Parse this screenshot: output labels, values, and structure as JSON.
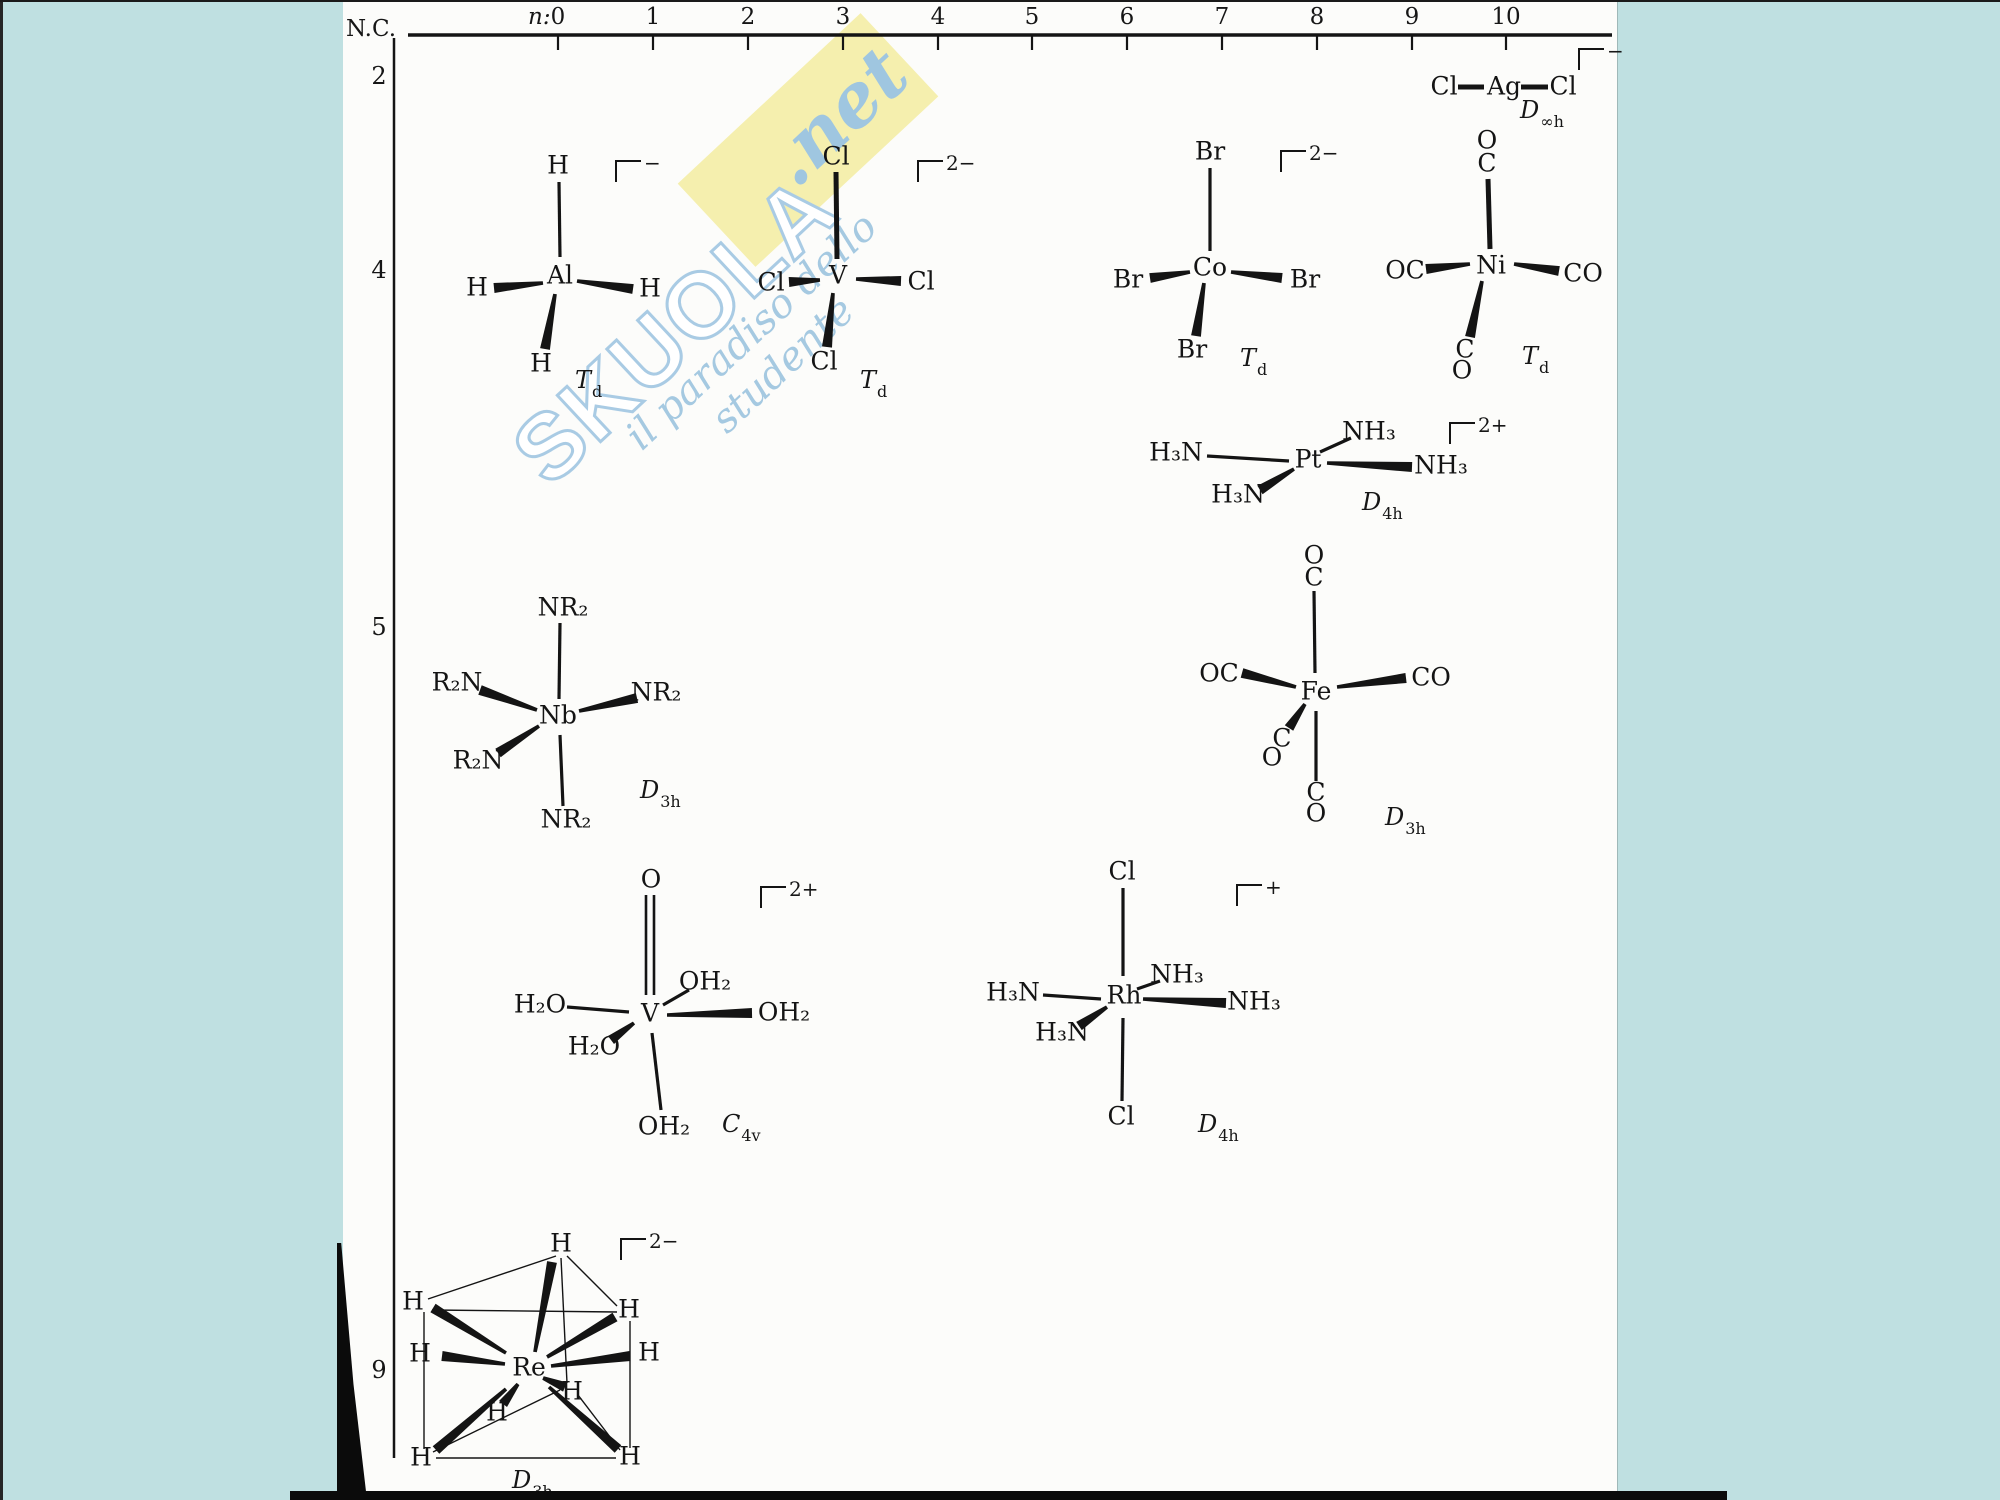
{
  "meta": {
    "description": "Scanned textbook figure: transition-metal complex geometries arranged by coordination number (N.C.) versus d-electron count (n)"
  },
  "watermark": {
    "brand": "SKUOLA",
    "domain": ".net",
    "tagline": "il paradiso dello studente",
    "band_color": "#f5efae",
    "text_color": "#a5c9e1"
  },
  "axis": {
    "nc_label": "N.C.",
    "n_label": "n:",
    "n_ticks": [
      {
        "label": "0",
        "x": 558
      },
      {
        "label": "1",
        "x": 653
      },
      {
        "label": "2",
        "x": 748
      },
      {
        "label": "3",
        "x": 843
      },
      {
        "label": "4",
        "x": 938
      },
      {
        "label": "5",
        "x": 1032
      },
      {
        "label": "6",
        "x": 1127
      },
      {
        "label": "7",
        "x": 1222
      },
      {
        "label": "8",
        "x": 1317
      },
      {
        "label": "9",
        "x": 1412
      },
      {
        "label": "10",
        "x": 1506
      }
    ],
    "nc_rows": [
      {
        "label": "2",
        "y": 76
      },
      {
        "label": "4",
        "y": 270
      },
      {
        "label": "5",
        "y": 627
      },
      {
        "label": "9",
        "y": 1370
      }
    ],
    "h_line": {
      "x1": 408,
      "y1": 35,
      "x2": 1612,
      "y2": 35
    },
    "v_line": {
      "x1": 394,
      "y1": 38,
      "x2": 394,
      "y2": 1458
    },
    "tick_len": 15
  },
  "molecules": [
    {
      "name": "dichloroargentate",
      "formula": "[AgCl2]-",
      "symmetry": {
        "main": "D",
        "sub": "∞h"
      },
      "sym_pos": [
        1520,
        98
      ],
      "charge": "−",
      "charge_pos": [
        1578,
        48
      ],
      "atoms": [
        [
          "Cl",
          1444,
          88
        ],
        [
          "Ag",
          1504,
          88
        ],
        [
          "Cl",
          1563,
          88
        ]
      ],
      "bonds": [
        [
          "thick",
          1458,
          87,
          1484,
          87
        ],
        [
          "thick",
          1521,
          87,
          1548,
          87
        ]
      ]
    },
    {
      "name": "tetrahydridoaluminate",
      "formula": "[AlH4]-",
      "symmetry": {
        "main": "T",
        "sub": "d"
      },
      "sym_pos": [
        575,
        368
      ],
      "charge": "−",
      "charge_pos": [
        615,
        160
      ],
      "atoms": [
        [
          "Al",
          560,
          277
        ],
        [
          "H",
          558,
          167
        ],
        [
          "H",
          477,
          289
        ],
        [
          "H",
          650,
          290
        ],
        [
          "H",
          541,
          365
        ]
      ],
      "bonds": [
        [
          "line",
          559,
          182,
          560,
          257
        ],
        [
          "wedge",
          543,
          283,
          494,
          288
        ],
        [
          "wedge",
          577,
          281,
          633,
          289
        ],
        [
          "wedge",
          555,
          294,
          545,
          349
        ]
      ]
    },
    {
      "name": "tetrachlorovanadate",
      "formula": "[VCl4]2-",
      "symmetry": {
        "main": "T",
        "sub": "d"
      },
      "sym_pos": [
        860,
        368
      ],
      "charge": "2−",
      "charge_pos": [
        917,
        160
      ],
      "atoms": [
        [
          "V",
          838,
          277
        ],
        [
          "Cl",
          836,
          158
        ],
        [
          "Cl",
          771,
          284
        ],
        [
          "Cl",
          921,
          283
        ],
        [
          "Cl",
          824,
          363
        ]
      ],
      "bonds": [
        [
          "thick",
          836,
          172,
          837,
          259
        ],
        [
          "wedge",
          820,
          280,
          789,
          282
        ],
        [
          "wedge",
          856,
          279,
          901,
          281
        ],
        [
          "wedge",
          833,
          293,
          827,
          347
        ]
      ]
    },
    {
      "name": "tetrabromocobaltate",
      "formula": "[CoBr4]2-",
      "symmetry": {
        "main": "T",
        "sub": "d"
      },
      "sym_pos": [
        1240,
        346
      ],
      "charge": "2−",
      "charge_pos": [
        1280,
        150
      ],
      "atoms": [
        [
          "Co",
          1210,
          269
        ],
        [
          "Br",
          1210,
          153
        ],
        [
          "Br",
          1128,
          281
        ],
        [
          "Br",
          1305,
          281
        ],
        [
          "Br",
          1192,
          351
        ]
      ],
      "bonds": [
        [
          "line",
          1210,
          168,
          1210,
          251
        ],
        [
          "wedge",
          1190,
          272,
          1150,
          278
        ],
        [
          "wedge",
          1231,
          272,
          1282,
          278
        ],
        [
          "wedge",
          1204,
          283,
          1196,
          336
        ]
      ]
    },
    {
      "name": "nickel-tetracarbonyl",
      "formula": "Ni(CO)4",
      "symmetry": {
        "main": "T",
        "sub": "d"
      },
      "sym_pos": [
        1522,
        344
      ],
      "charge": null,
      "charge_pos": null,
      "atoms": [
        [
          "O",
          1487,
          142
        ],
        [
          "C",
          1487,
          165
        ],
        [
          "Ni",
          1491,
          267
        ],
        [
          "OC",
          1405,
          272
        ],
        [
          "CO",
          1583,
          275
        ],
        [
          "C",
          1465,
          351
        ],
        [
          "O",
          1462,
          372
        ]
      ],
      "bonds": [
        [
          "thick",
          1488,
          179,
          1490,
          249
        ],
        [
          "wedge",
          1470,
          264,
          1426,
          269
        ],
        [
          "wedge",
          1514,
          264,
          1559,
          271
        ],
        [
          "wedge",
          1482,
          281,
          1470,
          337
        ]
      ]
    },
    {
      "name": "tetraammineplatinum",
      "formula": "[Pt(NH3)4]2+",
      "symmetry": {
        "main": "D",
        "sub": "4h"
      },
      "sym_pos": [
        1362,
        490
      ],
      "charge": "2+",
      "charge_pos": [
        1449,
        422
      ],
      "atoms": [
        [
          "Pt",
          1308,
          461
        ],
        [
          "NH₃",
          1369,
          433
        ],
        [
          "H₃N",
          1176,
          454
        ],
        [
          "H₃N",
          1238,
          496
        ],
        [
          "NH₃",
          1441,
          467
        ]
      ],
      "bonds": [
        [
          "line",
          1320,
          452,
          1351,
          438
        ],
        [
          "line",
          1207,
          456,
          1289,
          461
        ],
        [
          "wedge",
          1294,
          469,
          1260,
          490
        ],
        [
          "wedge",
          1327,
          463,
          1412,
          467
        ]
      ]
    },
    {
      "name": "pentakis-dialkylamido-niobium",
      "formula": "Nb(NR2)5",
      "symmetry": {
        "main": "D",
        "sub": "3h"
      },
      "sym_pos": [
        640,
        778
      ],
      "charge": null,
      "charge_pos": null,
      "atoms": [
        [
          "Nb",
          558,
          717
        ],
        [
          "NR₂",
          563,
          609
        ],
        [
          "R₂N",
          457,
          684
        ],
        [
          "NR₂",
          656,
          694
        ],
        [
          "R₂N",
          478,
          762
        ],
        [
          "NR₂",
          566,
          821
        ]
      ],
      "bonds": [
        [
          "line",
          560,
          623,
          559,
          699
        ],
        [
          "line",
          560,
          735,
          563,
          806
        ],
        [
          "wedge",
          537,
          710,
          480,
          690
        ],
        [
          "wedge",
          579,
          711,
          637,
          698
        ],
        [
          "wedge",
          539,
          726,
          498,
          753
        ]
      ]
    },
    {
      "name": "iron-pentacarbonyl",
      "formula": "Fe(CO)5",
      "symmetry": {
        "main": "D",
        "sub": "3h"
      },
      "sym_pos": [
        1385,
        805
      ],
      "charge": null,
      "charge_pos": null,
      "atoms": [
        [
          "O",
          1314,
          557
        ],
        [
          "C",
          1314,
          579
        ],
        [
          "Fe",
          1316,
          693
        ],
        [
          "OC",
          1219,
          675
        ],
        [
          "CO",
          1431,
          679
        ],
        [
          "C",
          1282,
          740
        ],
        [
          "O",
          1272,
          759
        ],
        [
          "C",
          1316,
          794
        ],
        [
          "O",
          1316,
          815
        ]
      ],
      "bonds": [
        [
          "line",
          1314,
          591,
          1315,
          673
        ],
        [
          "line",
          1316,
          711,
          1316,
          781
        ],
        [
          "wedge",
          1296,
          687,
          1242,
          673
        ],
        [
          "wedge",
          1337,
          687,
          1406,
          678
        ],
        [
          "wedge",
          1305,
          704,
          1289,
          728
        ]
      ]
    },
    {
      "name": "oxo-pentaaqua-vanadium",
      "formula": "[VO(OH2)5]2+",
      "symmetry": {
        "main": "C",
        "sub": "4v"
      },
      "sym_pos": [
        722,
        1112
      ],
      "charge": "2+",
      "charge_pos": [
        760,
        886
      ],
      "atoms": [
        [
          "O",
          651,
          881
        ],
        [
          "V",
          650,
          1015
        ],
        [
          "OH₂",
          705,
          983
        ],
        [
          "H₂O",
          540,
          1006
        ],
        [
          "H₂O",
          594,
          1048
        ],
        [
          "OH₂",
          784,
          1014
        ],
        [
          "OH₂",
          664,
          1128
        ]
      ],
      "bonds": [
        [
          "double",
          650,
          895,
          650,
          995
        ],
        [
          "line",
          663,
          1005,
          689,
          990
        ],
        [
          "line",
          567,
          1007,
          629,
          1012
        ],
        [
          "wedge",
          634,
          1023,
          611,
          1040
        ],
        [
          "wedge",
          667,
          1015,
          752,
          1013
        ],
        [
          "line",
          652,
          1033,
          661,
          1110
        ]
      ]
    },
    {
      "name": "dichloro-tetraammine-rhodium",
      "formula": "[RhCl2(NH3)4]+",
      "symmetry": {
        "main": "D",
        "sub": "4h"
      },
      "sym_pos": [
        1198,
        1112
      ],
      "charge": "+",
      "charge_pos": [
        1236,
        884
      ],
      "atoms": [
        [
          "Cl",
          1122,
          873
        ],
        [
          "Rh",
          1124,
          997
        ],
        [
          "Cl",
          1121,
          1118
        ],
        [
          "H₃N",
          1013,
          994
        ],
        [
          "NH₃",
          1177,
          976
        ],
        [
          "H₃N",
          1062,
          1034
        ],
        [
          "NH₃",
          1254,
          1003
        ]
      ],
      "bonds": [
        [
          "line",
          1123,
          888,
          1123,
          976
        ],
        [
          "line",
          1123,
          1018,
          1122,
          1101
        ],
        [
          "line",
          1043,
          995,
          1101,
          999
        ],
        [
          "line",
          1137,
          989,
          1160,
          981
        ],
        [
          "wedge",
          1107,
          1007,
          1079,
          1026
        ],
        [
          "wedge",
          1143,
          999,
          1226,
          1003
        ]
      ]
    },
    {
      "name": "nonahydridorhenate",
      "formula": "[ReH9]2-",
      "symmetry": {
        "main": "D",
        "sub": "3h"
      },
      "sym_pos": [
        512,
        1468
      ],
      "charge": "2−",
      "charge_pos": [
        620,
        1238
      ],
      "atoms": [
        [
          "Re",
          529,
          1369
        ],
        [
          "H",
          561,
          1245
        ],
        [
          "H",
          413,
          1303
        ],
        [
          "H",
          629,
          1311
        ],
        [
          "H",
          420,
          1355
        ],
        [
          "H",
          649,
          1354
        ],
        [
          "H",
          572,
          1393
        ],
        [
          "H",
          497,
          1414
        ],
        [
          "H",
          421,
          1459
        ],
        [
          "H",
          630,
          1458
        ]
      ],
      "bonds": [
        [
          "thin",
          556,
          1256,
          428,
          1299
        ],
        [
          "thin",
          567,
          1256,
          617,
          1306
        ],
        [
          "thin",
          432,
          1310,
          617,
          1312
        ],
        [
          "thin",
          424,
          1312,
          424,
          1449
        ],
        [
          "thin",
          630,
          1321,
          630,
          1448
        ],
        [
          "thin",
          436,
          1458,
          616,
          1458
        ],
        [
          "thin",
          561,
          1258,
          567,
          1383
        ],
        [
          "thin",
          433,
          1452,
          560,
          1390
        ],
        [
          "thin",
          620,
          1450,
          578,
          1395
        ],
        [
          "wedge",
          535,
          1352,
          552,
          1262
        ],
        [
          "wedge",
          506,
          1353,
          433,
          1308
        ],
        [
          "wedge",
          547,
          1357,
          615,
          1317
        ],
        [
          "wedge",
          505,
          1364,
          442,
          1356
        ],
        [
          "wedge",
          551,
          1366,
          630,
          1356
        ],
        [
          "wedge",
          543,
          1378,
          565,
          1387
        ],
        [
          "wedge",
          518,
          1384,
          503,
          1404
        ],
        [
          "wedge",
          506,
          1389,
          436,
          1450
        ],
        [
          "wedge",
          549,
          1387,
          618,
          1449
        ]
      ]
    }
  ]
}
